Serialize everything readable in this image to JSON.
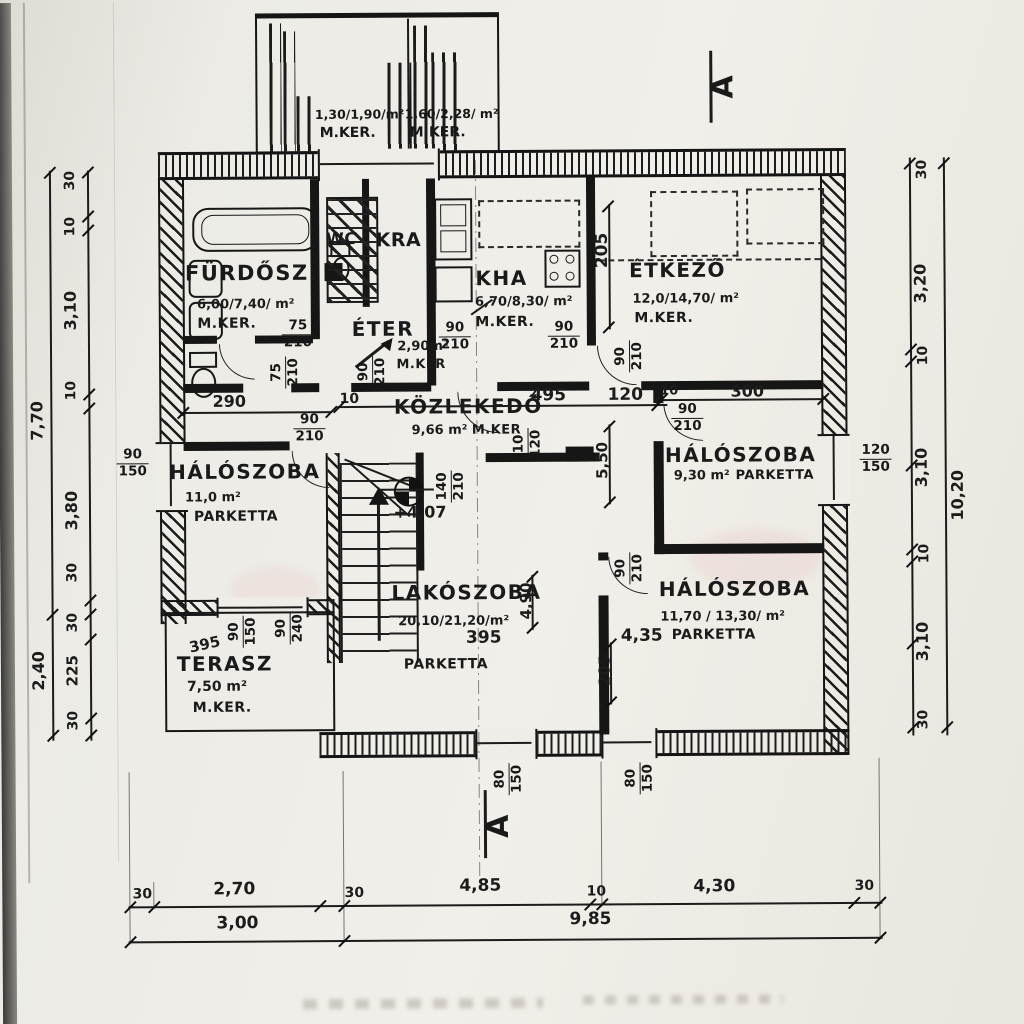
{
  "palette": {
    "paper": "#eceae3",
    "ink": "#181818"
  },
  "section_marker": "A",
  "level_mark": "+4,07",
  "balcony": {
    "left": {
      "area": "1,30/1,90/m²",
      "floor": "M.KER."
    },
    "right": {
      "area": "1,60/2,28/ m²",
      "floor": "M.KER."
    }
  },
  "rooms": {
    "furdosz": {
      "name": "FÜRDŐSZ.",
      "area": "6,00/7,40/ m²",
      "floor": "M.KER."
    },
    "wc": {
      "name": "WC"
    },
    "kra": {
      "name": "KRA"
    },
    "kha": {
      "name": "KHA",
      "area": "6,70/8,30/ m²",
      "floor": "M.KER."
    },
    "etkezo": {
      "name": "ÉTKEZŐ",
      "area": "12,0/14,70/ m²",
      "floor": "M.KER."
    },
    "eter": {
      "name": "ÉTER",
      "area": "2,90m²",
      "floor": "M.KER"
    },
    "kozlekedo": {
      "name": "KÖZLEKEDŐ",
      "area": "9,66 m²",
      "floor": "M.KER"
    },
    "halo_left": {
      "name": "HÁLÓSZOBA",
      "area": "11,0 m²",
      "floor": "PARKETTA"
    },
    "halo_right": {
      "name": "HÁLÓSZOBA",
      "area": "9,30 m²",
      "floor": "PARKETTA"
    },
    "lakoszoba": {
      "name": "LAKÓSZOBA",
      "area": "20,10/21,20/m²",
      "floor": "PARKETTA",
      "width": "395"
    },
    "halo_bottom": {
      "name": "HÁLÓSZOBA",
      "area": "11,70 / 13,30/ m²",
      "floor": "PARKETTA",
      "width": "4,35"
    },
    "terasz": {
      "name": "TERASZ",
      "area": "7,50 m²",
      "floor": "M.KER.",
      "width": "395"
    }
  },
  "dims": {
    "left_chain": [
      "30",
      "10",
      "3,10",
      "10",
      "3,80",
      "30"
    ],
    "left_total": "7,70",
    "terrace_chain": [
      "30",
      "225",
      "30"
    ],
    "terrace_total": "2,40",
    "right_chain": [
      "30",
      "3,20",
      "10",
      "3,10",
      "10",
      "3,10",
      "30"
    ],
    "right_total": "10,20",
    "bottom_chain": [
      "30",
      "2,70",
      "30",
      "4,85",
      "10",
      "4,30",
      "30"
    ],
    "bottom_totals": [
      "3,00",
      "9,85"
    ],
    "interior": {
      "w290": "290",
      "d90": "90",
      "d210": "210",
      "d75": "75",
      "d10": "10",
      "c495": "495",
      "c120": "120",
      "w300": "300",
      "v550": "5,50",
      "v205": "205",
      "v490": "4,90",
      "d140": "140",
      "w150": "150",
      "w80": "80",
      "w120": "120",
      "w240": "240"
    }
  }
}
